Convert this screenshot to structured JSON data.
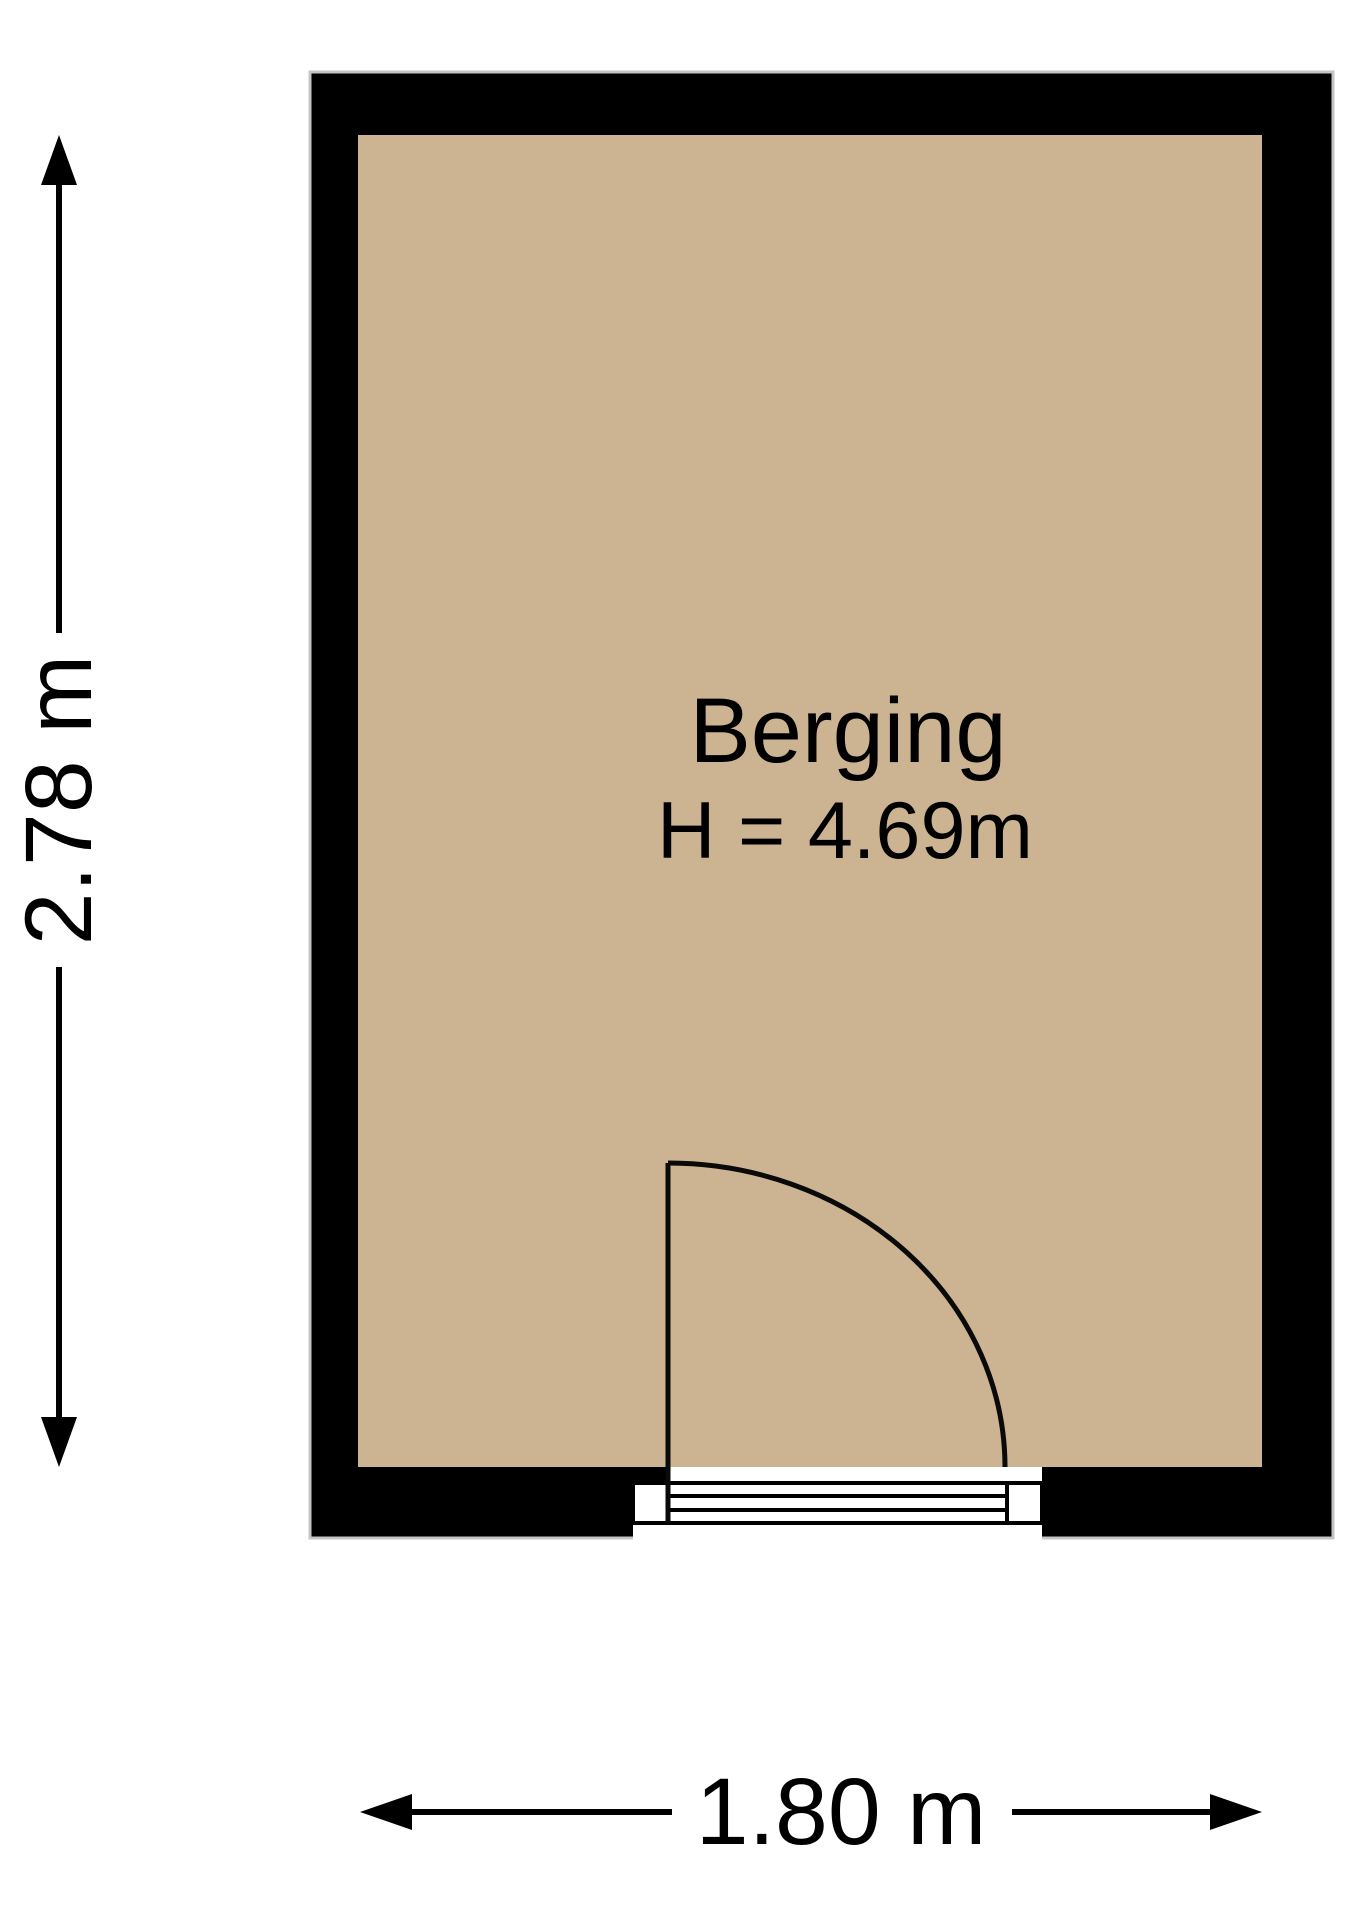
{
  "floorplan": {
    "room": {
      "name": "Berging",
      "height_label": "H = 4.69m"
    },
    "dimensions": {
      "vertical": "2.78 m",
      "horizontal": "1.80 m"
    },
    "colors": {
      "floor": "#CCB492",
      "wall": "#000000",
      "plan_outline": "#C5C5C5",
      "background": "#FFFFFF",
      "text": "#000000"
    }
  }
}
